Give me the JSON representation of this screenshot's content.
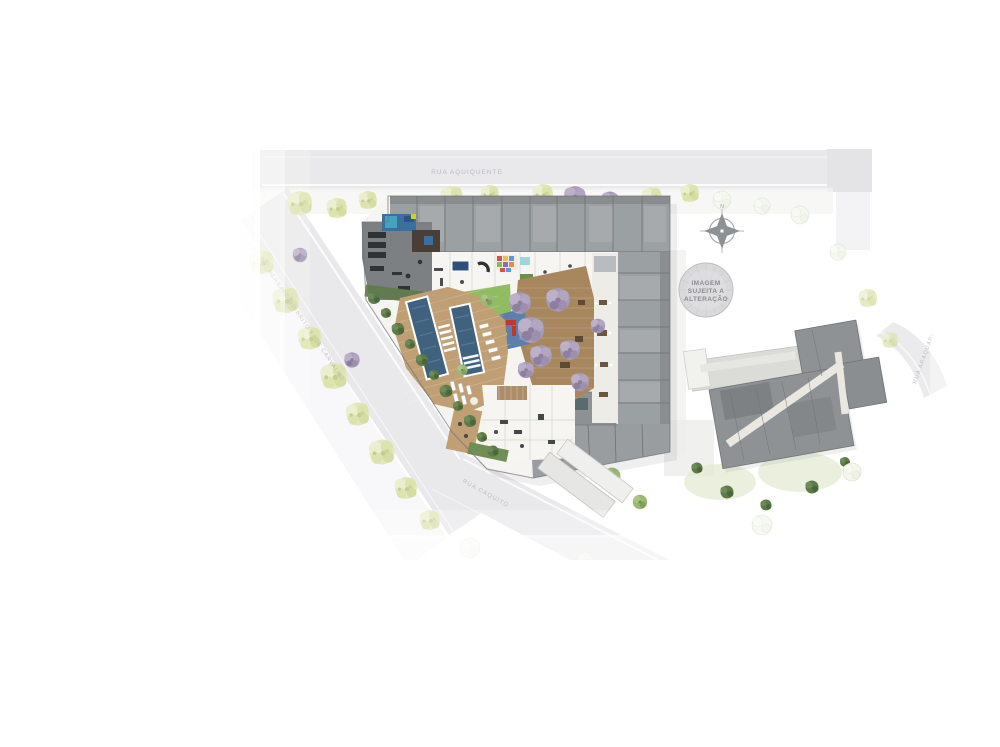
{
  "labels": {
    "street_top": "RUA AQUIQUENTE",
    "street_left": "AV. DR. BERNARDINO BRITO F. DE CARVALHO",
    "street_bottom": "RUA CAQUITO",
    "street_right": "RUA ARAQUARI",
    "watermark_line1": "IMAGEM",
    "watermark_line2": "SUJEITA A",
    "watermark_line3": "ALTERAÇÃO",
    "compass_north": "N"
  },
  "colors": {
    "background": "#ffffff",
    "street": "#e9e9eb",
    "sidewalk": "#f3f3f5",
    "curb": "#ffffff",
    "roof_main": "#9ba0a3",
    "roof_alt": "#8f9396",
    "roof_dark": "#7c8083",
    "roof_line": "#6e7275",
    "floor_white": "#f5f4f0",
    "corridor": "#eeece6",
    "deck_wood": "#a8875f",
    "deck_wood_light": "#bf9f73",
    "pool_water": "#41627f",
    "pool_water_light": "#5b7f9d",
    "lawn": "#90bc62",
    "hedge": "#5d7a49",
    "tree_yellow_green": "#e3e8bc",
    "tree_purple": "#a89bb7",
    "playground_mat": "#5b80ae",
    "play_equipment": "#c0392b",
    "glass_blue": "#3a6f9e",
    "phase2_light": "#dbdcd8",
    "phase2_dark": "#8f9295",
    "watermark_fill": "#d9d9db",
    "watermark_text": "#8b8b8f",
    "label_text": "#b2b2b8"
  }
}
